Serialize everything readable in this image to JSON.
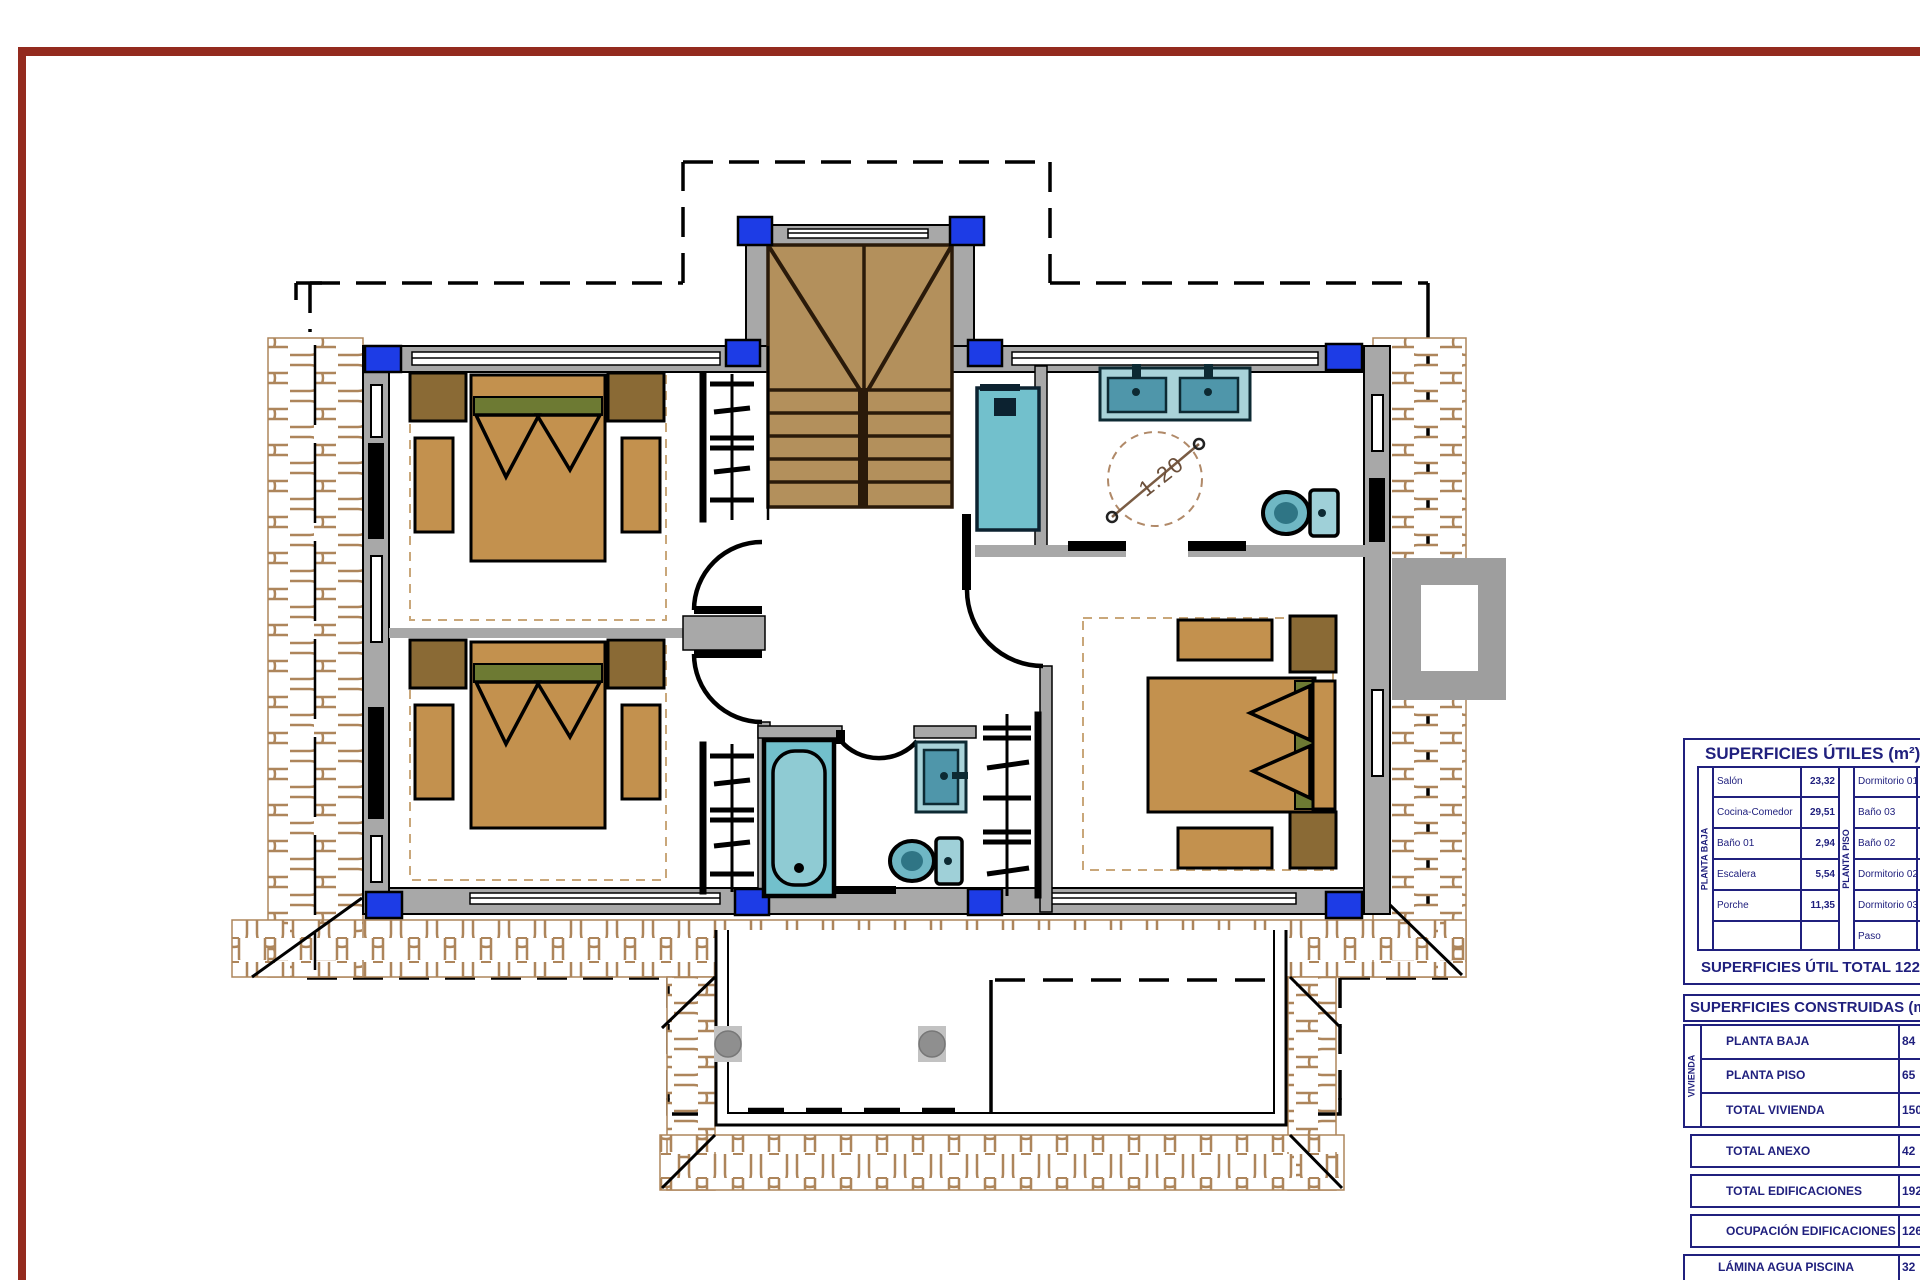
{
  "plan": {
    "turning_circle_label": "1.20",
    "colors": {
      "frame_maroon": "#932a1e",
      "wall_gray": "#a8a8a8",
      "pillar_blue": "#1d3ce6",
      "stair_wood": "#b3905c",
      "stair_dark": "#2a1a0a",
      "bed_tan": "#c3914e",
      "nightstand_brown": "#8a6a35",
      "pillow_olive": "#6d7a33",
      "fixture_teal": "#72c0cc",
      "fixture_teal_dark": "#4f96aa",
      "tile_brown": "#ad855b",
      "dashed_tan": "#c9a77a",
      "table_navy": "#20207e"
    }
  },
  "tables": {
    "utiles": {
      "title": "SUPERFICIES ÚTILES (m²)",
      "groups": [
        {
          "label": "PLANTA BAJA",
          "rows": [
            {
              "name": "Salón",
              "value": "23,32"
            },
            {
              "name": "Cocina-Comedor",
              "value": "29,51"
            },
            {
              "name": "Baño 01",
              "value": "2,94"
            },
            {
              "name": "Escalera",
              "value": "5,54"
            },
            {
              "name": "Porche",
              "value": "11,35"
            },
            {
              "name": "",
              "value": ""
            }
          ]
        },
        {
          "label": "PLANTA PISO",
          "rows": [
            {
              "name": "Dormitorio 01",
              "value": ""
            },
            {
              "name": "Baño 03",
              "value": ""
            },
            {
              "name": "Baño 02",
              "value": ""
            },
            {
              "name": "Dormitorio 02",
              "value": ""
            },
            {
              "name": "Dormitorio 03",
              "value": ""
            },
            {
              "name": "Paso",
              "value": ""
            }
          ]
        }
      ],
      "total": "SUPERFICIES ÚTIL TOTAL 122,66 m²"
    },
    "construidas": {
      "title": "SUPERFICIES CONSTRUIDAS (m²)",
      "vivienda_label": "VIVIENDA",
      "vivienda_rows": [
        {
          "name": "PLANTA BAJA",
          "value": "84"
        },
        {
          "name": "PLANTA PISO",
          "value": "65"
        },
        {
          "name": "TOTAL VIVIENDA",
          "value": "150"
        }
      ],
      "extra_rows": [
        {
          "name": "TOTAL ANEXO",
          "value": "42"
        },
        {
          "name": "TOTAL EDIFICACIONES",
          "value": "192"
        },
        {
          "name": "OCUPACIÓN EDIFICACIONES",
          "value": "126"
        },
        {
          "name": "LÁMINA AGUA PISCINA",
          "value": "32"
        }
      ]
    }
  }
}
